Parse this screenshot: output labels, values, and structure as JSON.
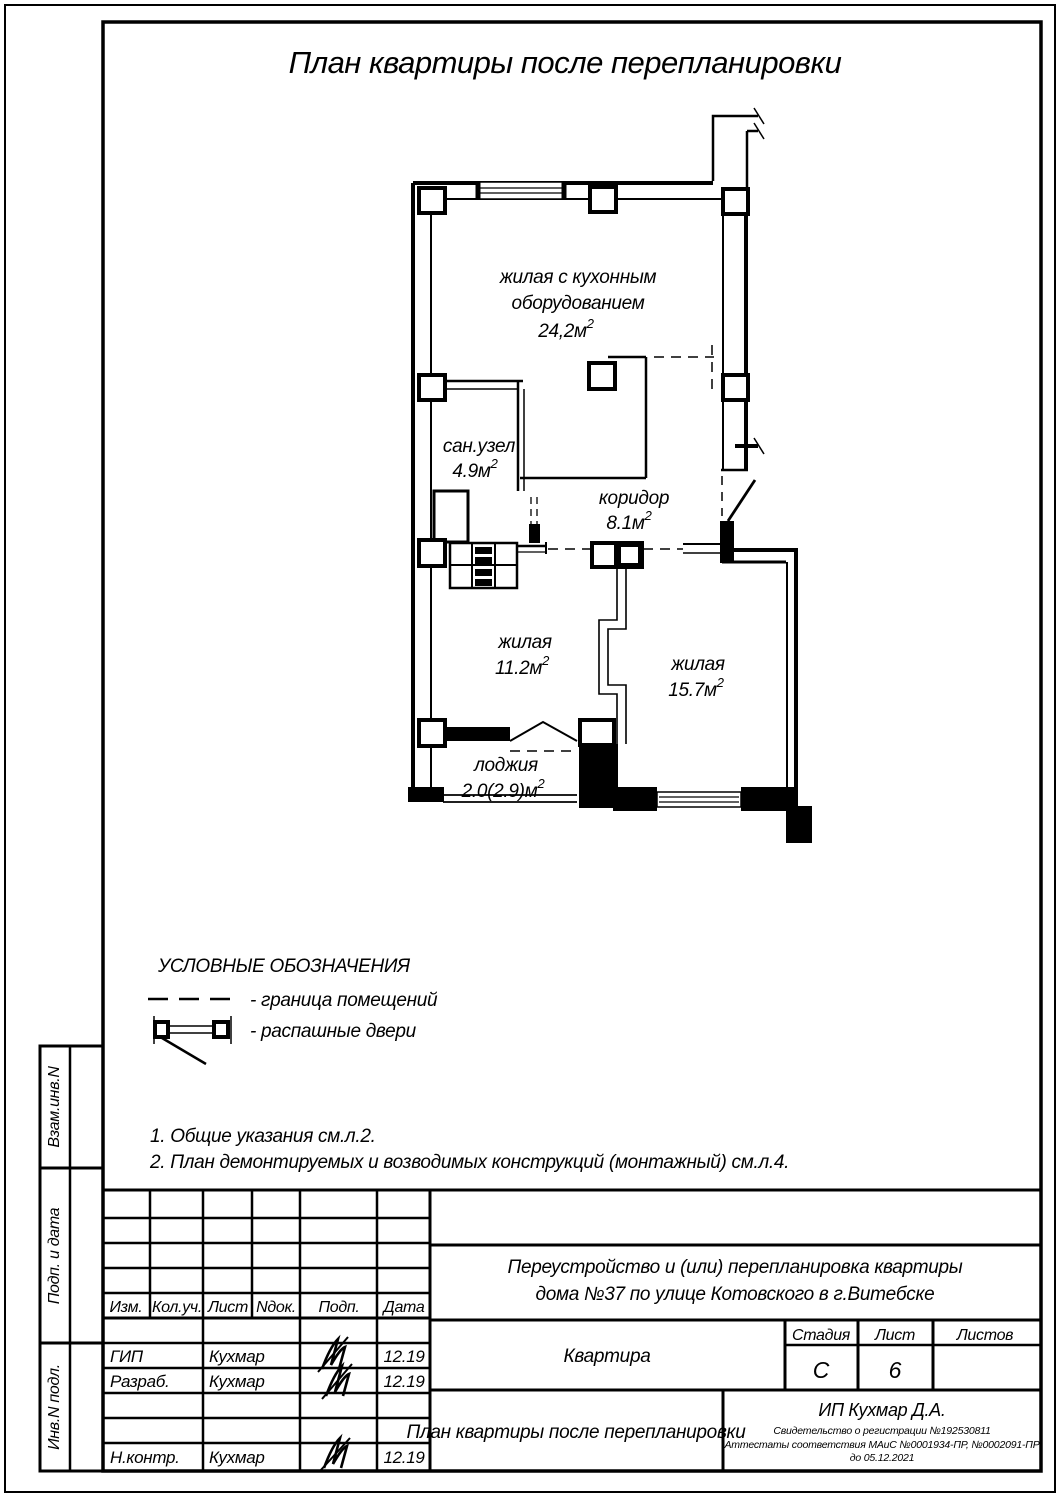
{
  "page": {
    "title": "План квартиры после перепланировки"
  },
  "floor_plan": {
    "rooms": [
      {
        "id": "living-kitchen",
        "label": "жилая с кухонным",
        "label2": "оборудованием",
        "area": "24,2м",
        "sup": "2"
      },
      {
        "id": "bathroom",
        "label": "сан.узел",
        "area": "4.9м",
        "sup": "2"
      },
      {
        "id": "corridor",
        "label": "коридор",
        "area": "8.1м",
        "sup": "2"
      },
      {
        "id": "living-1",
        "label": "жилая",
        "area": "11.2м",
        "sup": "2"
      },
      {
        "id": "living-2",
        "label": "жилая",
        "area": "15.7м",
        "sup": "2"
      },
      {
        "id": "loggia",
        "label": "лоджия",
        "area": "2.0(2.9)м",
        "sup": "2"
      }
    ]
  },
  "legend": {
    "title": "УСЛОВНЫЕ ОБОЗНАЧЕНИЯ",
    "items": [
      {
        "label": "- граница помещений"
      },
      {
        "label": "- распашные двери"
      }
    ]
  },
  "notes": [
    "1. Общие указания см.л.2.",
    "2. План демонтируемых и возводимых конструкций (монтажный) см.л.4."
  ],
  "sidebar": {
    "labels": [
      "Взам.инв.N",
      "Подп. и дата",
      "Инв.N подл."
    ]
  },
  "title_block": {
    "columns": [
      "Изм.",
      "Кол.уч.",
      "Лист",
      "Nдок.",
      "Подп.",
      "Дата"
    ],
    "signature_rows": [
      {
        "role": "ГИП",
        "name": "Кухмар",
        "date": "12.19"
      },
      {
        "role": "Разраб.",
        "name": "Кухмар",
        "date": "12.19"
      },
      {
        "role": "Н.контр.",
        "name": "Кухмар",
        "date": "12.19"
      }
    ],
    "project_line1": "Переустройство и (или) перепланировка квартиры",
    "project_line2": "дома №37 по улице Котовского в г.Витебске",
    "object_name": "Квартира",
    "sheet_name": "План квартиры после перепланировки",
    "stage_label": "Стадия",
    "list_label": "Лист",
    "lists_label": "Листов",
    "stage_value": "С",
    "list_value": "6",
    "lists_value": "",
    "company_name": "ИП Кухмар Д.А.",
    "company_cert": "Свидетельство о регистрации №192530811",
    "company_attest": "Аттестаты соответствия МАиС №0001934-ПР, №0002091-ПР",
    "company_valid": "до 05.12.2021"
  },
  "colors": {
    "ink": "#000000",
    "paper": "#ffffff"
  }
}
